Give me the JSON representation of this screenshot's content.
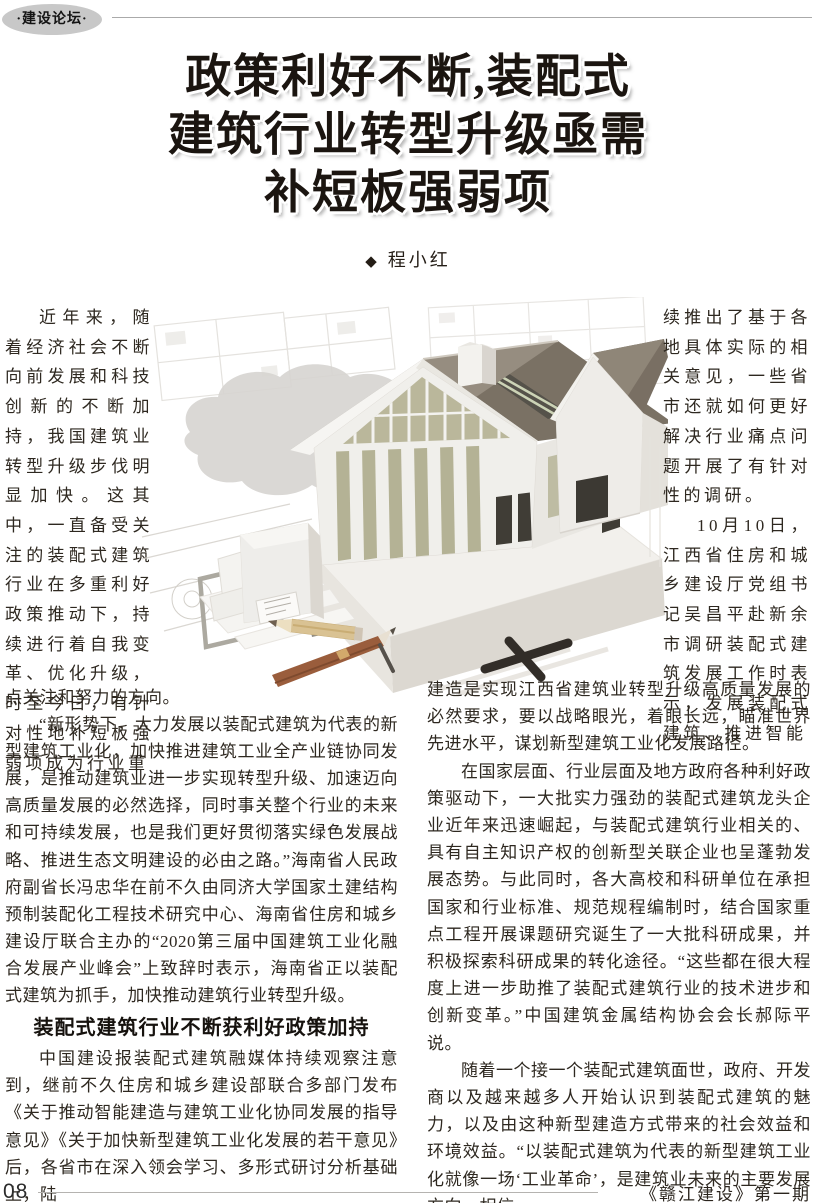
{
  "header": {
    "badge": "·建设论坛·"
  },
  "title": {
    "line1": "政策利好不断,装配式",
    "line2": "建筑行业转型升级亟需",
    "line3": "补短板强弱项"
  },
  "byline": {
    "marker": "◆",
    "author": "程小红"
  },
  "article": {
    "left_narrow_p1": "近年来，随着经济社会不断向前发展和科技创新的不断加持，我国建筑业转型升级步伐明显加快。这其中，一直备受关注的装配式建筑行业在多重利好政策推动下，持续进行着自我变革、优化升级，时至今日，有针对性地补短板强弱项成为行业重",
    "left_wide_p1_tail": "点关注和努力的方向。",
    "left_wide_p2": "“新形势下，大力发展以装配式建筑为代表的新型建筑工业化，加快推进建筑工业全产业链协同发展，是推动建筑业进一步实现转型升级、加速迈向高质量发展的必然选择，同时事关整个行业的未来和可持续发展，也是我们更好贯彻落实绿色发展战略、推进生态文明建设的必由之路。”海南省人民政府副省长冯忠华在前不久由同济大学国家土建结构预制装配化工程技术研究中心、海南省住房和城乡建设厅联合主办的“2020第三届中国建筑工业化融合发展产业峰会”上致辞时表示，海南省正以装配式建筑为抓手，加快推动建筑行业转型升级。",
    "section_heading": "装配式建筑行业不断获利好政策加持",
    "left_wide_p3": "中国建设报装配式建筑融媒体持续观察注意到，继前不久住房和城乡建设部联合多部门发布《关于推动智能建造与建筑工业化协同发展的指导意见》《关于加快新型建筑工业化发展的若干意见》后，各省市在深入领会学习、多形式研讨分析基础上，陆",
    "right_narrow_p1": "续推出了基于各地具体实际的相关意见，一些省市还就如何更好解决行业痛点问题开展了有针对性的调研。",
    "right_narrow_p2": "10月10日，江西省住房和城乡建设厅党组书记吴昌平赴新余市调研装配式建筑发展工作时表示，发展装配式建筑、推进智能",
    "right_wide_p1": "建造是实现江西省建筑业转型升级高质量发展的必然要求，要以战略眼光，着眼长远，瞄准世界先进水平，谋划新型建筑工业化发展路径。",
    "right_wide_p2": "在国家层面、行业层面及地方政府各种利好政策驱动下，一大批实力强劲的装配式建筑龙头企业近年来迅速崛起，与装配式建筑行业相关的、具有自主知识产权的创新型关联企业也呈蓬勃发展态势。与此同时，各大高校和科研单位在承担国家和行业标准、规范规程编制时，结合国家重点工程开展课题研究诞生了一大批科研成果，并积极探索科研成果的转化途径。“这些都在很大程度上进一步助推了装配式建筑行业的技术进步和创新变革。”中国建筑金属结构协会会长郝际平说。",
    "right_wide_p3": "随着一个接一个装配式建筑面世，政府、开发商以及越来越多人开始认识到装配式建筑的魅力，以及由这种新型建造方式带来的社会效益和环境效益。“以装配式建筑为代表的新型建筑工业化就像一场‘工业革命’，是建筑业未来的主要发展方向，相信"
  },
  "image": {
    "alt": "白色装配式住宅建筑模型置于建筑图纸上，旁有铅笔和钢笔",
    "colors": {
      "roof_nw": "#968d80",
      "roof_se": "#7a7164",
      "roof_second": "#8f8678",
      "wall": "#f0efeb",
      "glazing": "#bab79b",
      "base_top": "#f2f0ec",
      "base_front": "#dcd8d1",
      "cloud": "#d6d4d0",
      "blueprint_line": "#d9d6d1",
      "pencil_gold": "#d9c293",
      "pen_brown": "#9a5d3c",
      "dark_detail": "#322d28"
    }
  },
  "footer": {
    "page_number": "08",
    "journal": "《赣江建设》第一期"
  }
}
